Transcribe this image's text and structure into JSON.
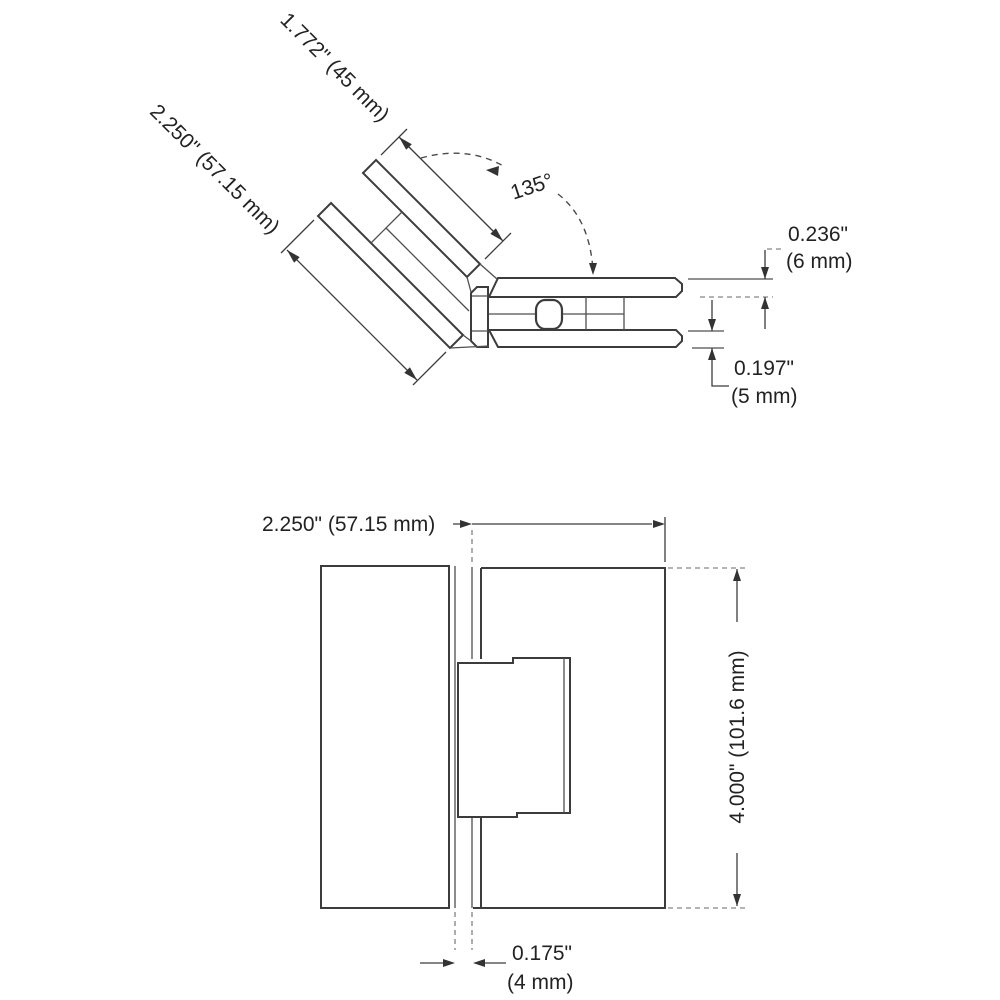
{
  "colors": {
    "background": "#ffffff",
    "line": "#3c3c3c",
    "text": "#222222"
  },
  "top_view": {
    "angle_label": "135°",
    "clamp_plate_length": "1.772\" (45 mm)",
    "body_width": "2.250\" (57.15 mm)",
    "plate_thickness_in": "0.236\"",
    "plate_thickness_mm": "(6 mm)",
    "glass_slot_in": "0.197\"",
    "glass_slot_mm": "(5 mm)"
  },
  "front_view": {
    "body_width": "2.250\" (57.15 mm)",
    "body_height": "4.000\" (101.6 mm)",
    "glass_gap_in": "0.175\"",
    "glass_gap_mm": "(4 mm)"
  }
}
